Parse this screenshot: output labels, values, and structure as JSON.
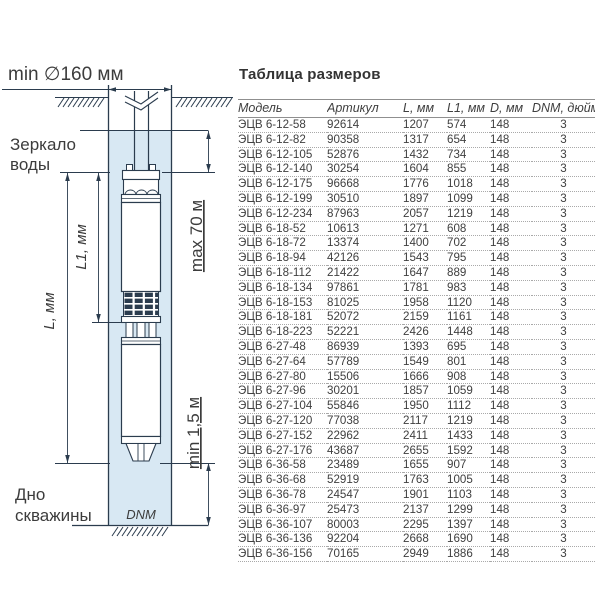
{
  "colors": {
    "water": "#d8e8f3",
    "ink": "#2b3c4e",
    "label": "#3c3c3c",
    "table_text": "#3f3f3f",
    "rule": "#8f8f8f",
    "dots": "#a9a9a9"
  },
  "diagram": {
    "labels": {
      "min_diameter": "min ∅160 мм",
      "water_level_line1": "Зеркало",
      "water_level_line2": "воды",
      "max_depth": "max 70 м",
      "l1_dim": "L1, мм",
      "l_dim": "L, мм",
      "min_bottom": "min 1,5 м",
      "well_bottom_line1": "Дно",
      "well_bottom_line2": "скважины",
      "dnm": "DNM"
    }
  },
  "table": {
    "title": "Таблица размеров",
    "headers": [
      "Модель",
      "Артикул",
      "L, мм",
      "L1, мм",
      "D, мм",
      "DNM, дюйм"
    ],
    "rows": [
      [
        "ЭЦВ 6-12-58",
        "92614",
        "1207",
        "574",
        "148",
        "3"
      ],
      [
        "ЭЦВ 6-12-82",
        "90358",
        "1317",
        "654",
        "148",
        "3"
      ],
      [
        "ЭЦВ 6-12-105",
        "52876",
        "1432",
        "734",
        "148",
        "3"
      ],
      [
        "ЭЦВ 6-12-140",
        "30254",
        "1604",
        "855",
        "148",
        "3"
      ],
      [
        "ЭЦВ 6-12-175",
        "96668",
        "1776",
        "1018",
        "148",
        "3"
      ],
      [
        "ЭЦВ 6-12-199",
        "30510",
        "1897",
        "1099",
        "148",
        "3"
      ],
      [
        "ЭЦВ 6-12-234",
        "87963",
        "2057",
        "1219",
        "148",
        "3"
      ],
      [
        "ЭЦВ 6-18-52",
        "10613",
        "1271",
        "608",
        "148",
        "3"
      ],
      [
        "ЭЦВ 6-18-72",
        "13374",
        "1400",
        "702",
        "148",
        "3"
      ],
      [
        "ЭЦВ 6-18-94",
        "42126",
        "1543",
        "795",
        "148",
        "3"
      ],
      [
        "ЭЦВ 6-18-112",
        "21422",
        "1647",
        "889",
        "148",
        "3"
      ],
      [
        "ЭЦВ 6-18-134",
        "97861",
        "1781",
        "983",
        "148",
        "3"
      ],
      [
        "ЭЦВ 6-18-153",
        "81025",
        "1958",
        "1120",
        "148",
        "3"
      ],
      [
        "ЭЦВ 6-18-181",
        "52072",
        "2159",
        "1161",
        "148",
        "3"
      ],
      [
        "ЭЦВ 6-18-223",
        "52221",
        "2426",
        "1448",
        "148",
        "3"
      ],
      [
        "ЭЦВ 6-27-48",
        "86939",
        "1393",
        "695",
        "148",
        "3"
      ],
      [
        "ЭЦВ 6-27-64",
        "57789",
        "1549",
        "801",
        "148",
        "3"
      ],
      [
        "ЭЦВ 6-27-80",
        "15506",
        "1666",
        "908",
        "148",
        "3"
      ],
      [
        "ЭЦВ 6-27-96",
        "30201",
        "1857",
        "1059",
        "148",
        "3"
      ],
      [
        "ЭЦВ 6-27-104",
        "55846",
        "1950",
        "1112",
        "148",
        "3"
      ],
      [
        "ЭЦВ 6-27-120",
        "77038",
        "2117",
        "1219",
        "148",
        "3"
      ],
      [
        "ЭЦВ 6-27-152",
        "22962",
        "2411",
        "1433",
        "148",
        "3"
      ],
      [
        "ЭЦВ 6-27-176",
        "43687",
        "2655",
        "1592",
        "148",
        "3"
      ],
      [
        "ЭЦВ 6-36-58",
        "23489",
        "1655",
        "907",
        "148",
        "3"
      ],
      [
        "ЭЦВ 6-36-68",
        "52919",
        "1763",
        "1005",
        "148",
        "3"
      ],
      [
        "ЭЦВ 6-36-78",
        "24547",
        "1901",
        "1103",
        "148",
        "3"
      ],
      [
        "ЭЦВ 6-36-97",
        "25473",
        "2137",
        "1299",
        "148",
        "3"
      ],
      [
        "ЭЦВ 6-36-107",
        "80003",
        "2295",
        "1397",
        "148",
        "3"
      ],
      [
        "ЭЦВ 6-36-136",
        "92204",
        "2668",
        "1690",
        "148",
        "3"
      ],
      [
        "ЭЦВ 6-36-156",
        "70165",
        "2949",
        "1886",
        "148",
        "3"
      ]
    ]
  }
}
